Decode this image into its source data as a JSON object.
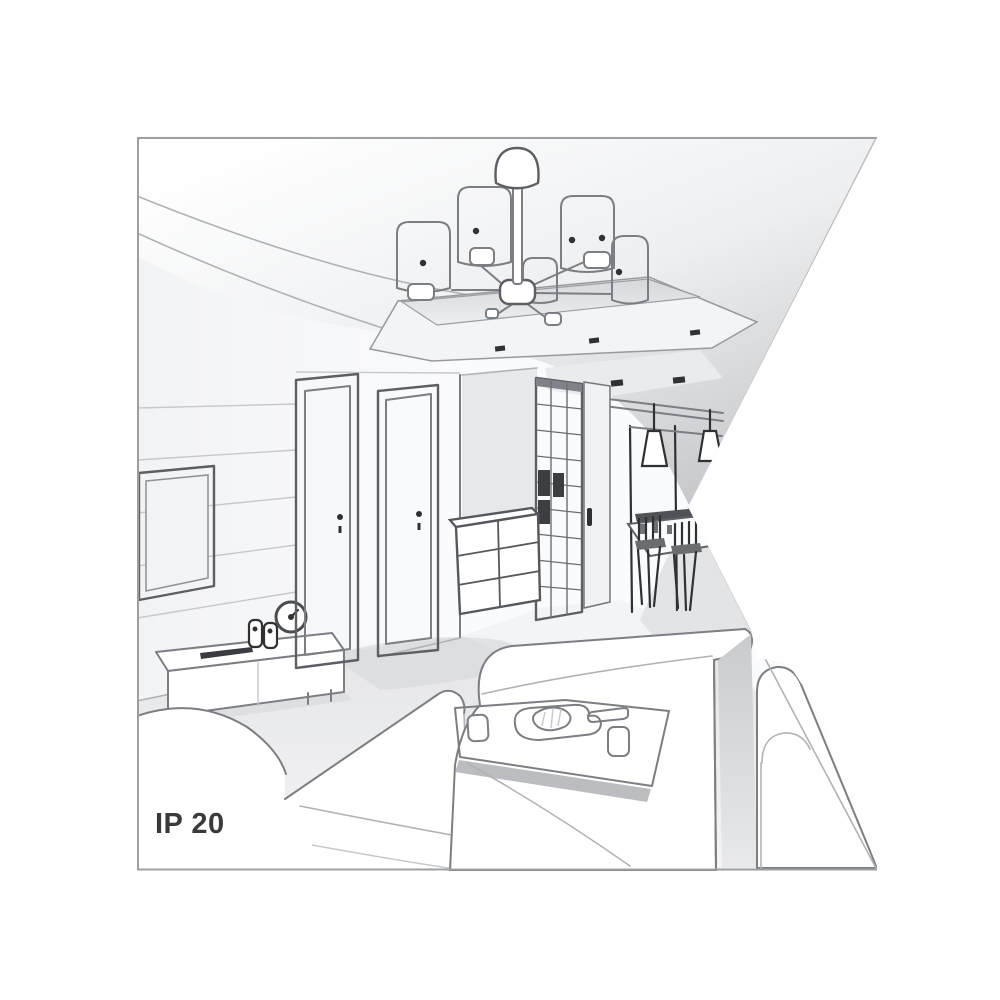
{
  "meta": {
    "kind": "interior-room-line-illustration",
    "ip_rating_label": "IP 20"
  },
  "theme": {
    "page_bg": "#ffffff",
    "white": "#ffffff",
    "paper": "#fafbfc",
    "line": "#7b7e82",
    "line_strong": "#5c5f63",
    "line_soft": "#b0b3b6",
    "dark": "#2f3133",
    "wall": "#f0f1f3",
    "floor": "#e7e8ea",
    "shadow": "#d8dadd",
    "stripe": "#b4b6b9",
    "ceiling_deep": "#c2c4c7",
    "text": "#3a3a3c",
    "border": "#9da0a3"
  },
  "scene": {
    "ip_rating": {
      "label": "IP 20"
    },
    "objects": [
      "chandelier with cylindrical shades",
      "recessed ceiling tray with spotlights",
      "tv on paneled wall",
      "tv sideboard with clock and speakers",
      "two interior doors",
      "chest of drawers",
      "hallway wardrobe",
      "dining nook with cone pendant lamps",
      "dining table with stools",
      "left sofa",
      "center chaise sofa",
      "right sofa",
      "coffee table with serving tray and cups"
    ]
  }
}
